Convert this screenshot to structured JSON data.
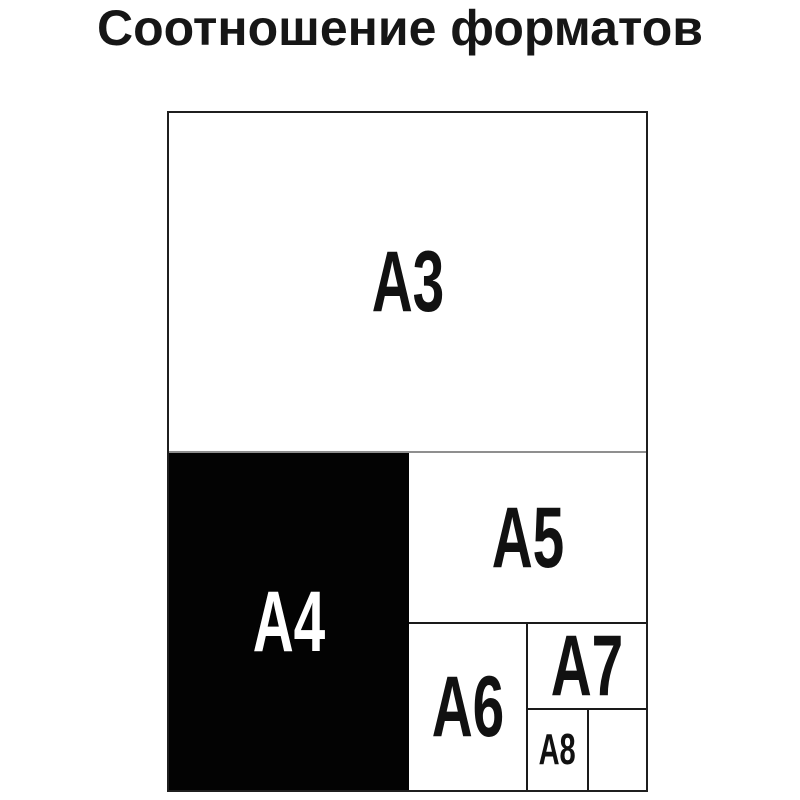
{
  "title": "Соотношение форматов",
  "diagram": {
    "description": "Nested comparison of ISO A-series paper formats",
    "formats": [
      {
        "id": "a3",
        "label": "A3"
      },
      {
        "id": "a4",
        "label": "A4"
      },
      {
        "id": "a5",
        "label": "A5"
      },
      {
        "id": "a6",
        "label": "A6"
      },
      {
        "id": "a7",
        "label": "A7"
      },
      {
        "id": "a8",
        "label": "A8"
      }
    ],
    "colors": {
      "background": "#ffffff",
      "outline": "#1f1f1f",
      "inner_line": "#1a1a1a",
      "light_divider": "#8f8f8f",
      "a4_fill": "#030303",
      "label_text": "#111111",
      "a4_label_text": "#ffffff",
      "title_text": "#161616"
    }
  }
}
